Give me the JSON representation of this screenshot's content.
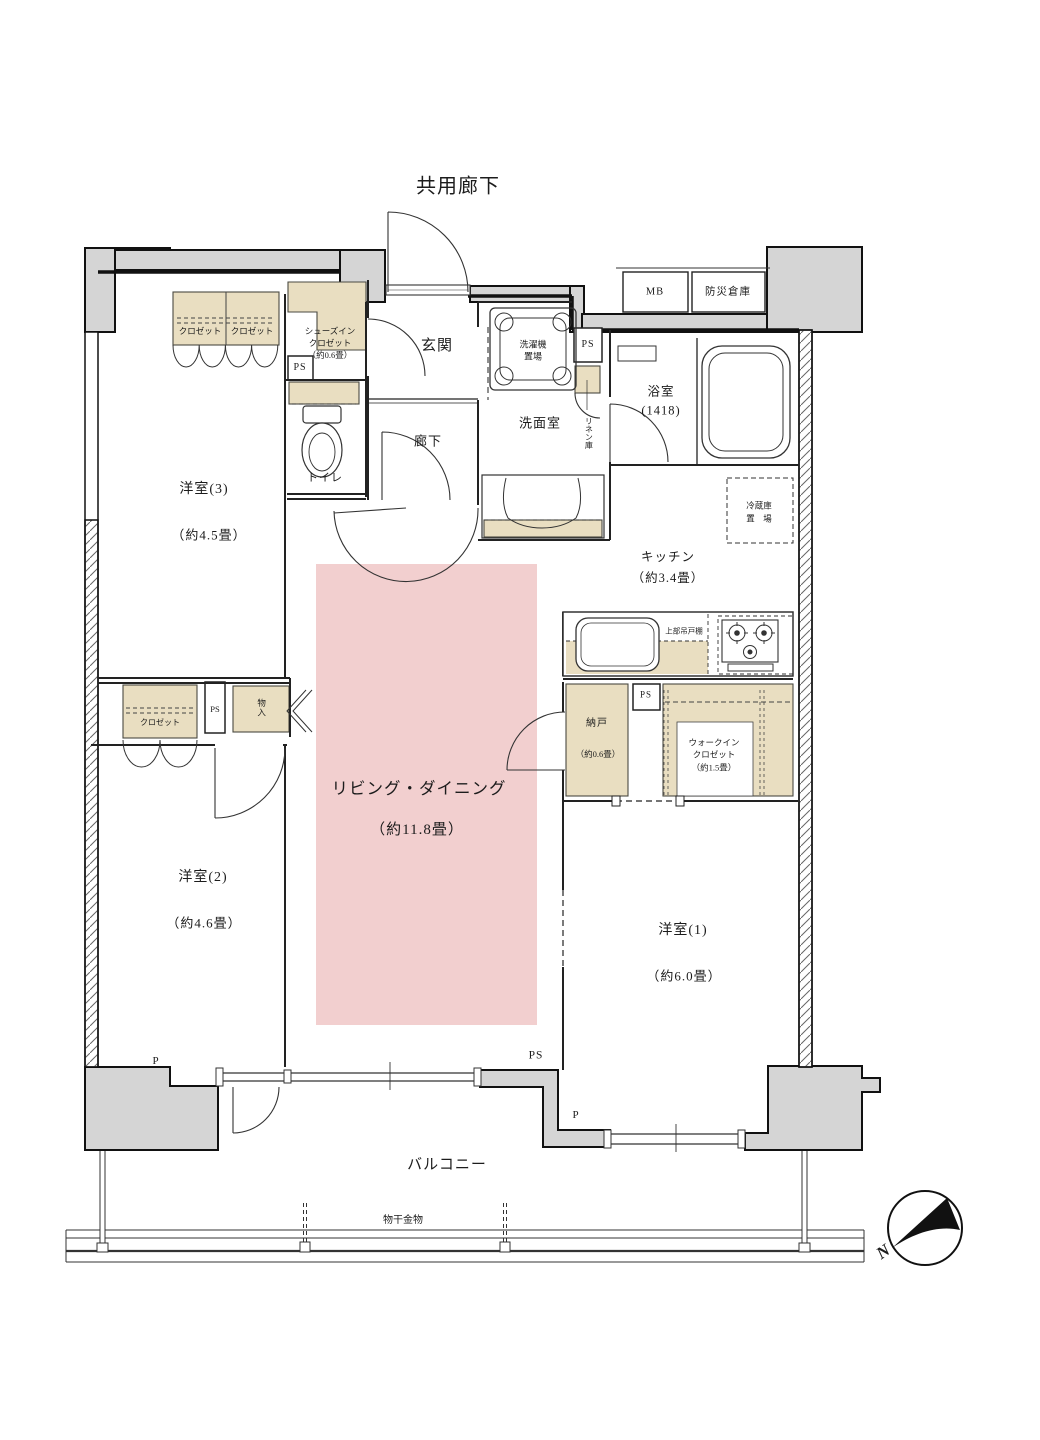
{
  "plan": {
    "type": "apartment-floor-plan",
    "accent_colors": {
      "ld_pink": "#f2cfcf",
      "closet_beige": "#e9dec1",
      "concrete_gray": "#d5d5d5"
    }
  },
  "labels": {
    "common_corridor": "共用廊下",
    "closet3a": "クロゼット",
    "closet3b": "クロゼット",
    "sic": "シューズイン\nクロゼット\n（約0.6畳）",
    "ps1": "PS",
    "toilet": "トイレ",
    "genkan": "玄関",
    "roka": "廊下",
    "washer": "洗濯機\n置場",
    "ps2": "PS",
    "linen": "リネン庫",
    "senmen": "洗面室",
    "bath": "浴室\n(1418)",
    "mb": "MB",
    "bosai": "防災倉庫",
    "fridge": "冷蔵庫\n置　場",
    "kitchen": "キッチン\n（約3.4畳）",
    "cupboard": "上部吊戸棚",
    "nando_name": "納戸",
    "nando_size": "（約0.6畳）",
    "ps3": "PS",
    "wic": "ウォークイン\nクロゼット\n（約1.5畳）",
    "ld_name": "リビング・ダイニング",
    "ld_size": "（約11.8畳）",
    "y3_name": "洋室(3)",
    "y3_size": "（約4.5畳）",
    "y2_name": "洋室(2)",
    "y2_size": "（約4.6畳）",
    "y1_name": "洋室(1)",
    "y1_size": "（約6.0畳）",
    "closet2": "クロゼット",
    "ps4": "PS",
    "monoire": "物入",
    "p_left": "P",
    "ps_bottom": "PS",
    "p_right": "P",
    "balcony": "バルコニー",
    "monohoshi": "物干金物",
    "north": "N"
  }
}
